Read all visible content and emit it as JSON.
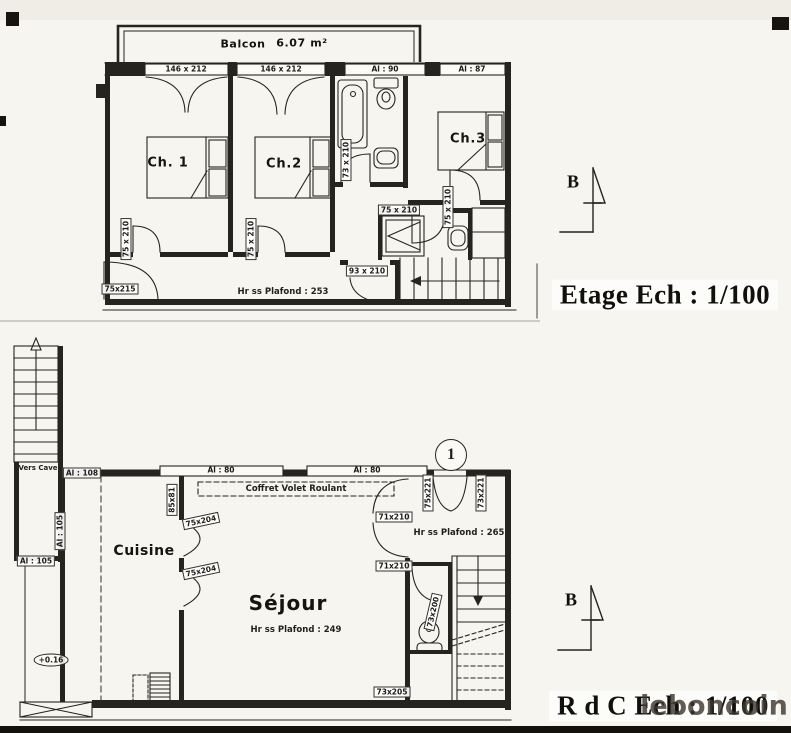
{
  "meta": {
    "watermark": "leboncoin"
  },
  "etage": {
    "title": "Etage Ech : 1/100",
    "section_marker": "B",
    "balcony": {
      "label": "Balcon",
      "area": "6.07 m²"
    },
    "windows": {
      "w1": "146 x 212",
      "w2": "146 x 212",
      "w3": "Al : 90",
      "w4": "Al : 87"
    },
    "rooms": {
      "ch1": "Ch. 1",
      "ch2": "Ch.2",
      "ch3": "Ch.3"
    },
    "ceiling_note": "Hr ss Plafond : 253",
    "doors": {
      "ch1": "75 x 210",
      "ch2": "75 x 210",
      "bath": "73 x 210",
      "shower": "75 x 210",
      "ch3": "75 x 210",
      "hall": "93 x 210",
      "entry": "75x215"
    }
  },
  "rdc": {
    "title": "R d C Ech : 1/100",
    "section_marker": "B",
    "stair_note": "Vers Cave",
    "marker_1": "1",
    "level_marker": "+0.16",
    "coffret_note": "Coffret Volet Roulant",
    "windows": {
      "al108": "Al : 108",
      "al105_side": "Al : 105",
      "al105_low": "Al : 105",
      "al80_a": "Al : 80",
      "al80_b": "Al : 80",
      "kitchen": "85x81"
    },
    "rooms": {
      "cuisine": "Cuisine",
      "sejour": "Séjour"
    },
    "ceiling_notes": {
      "entry": "Hr ss Plafond : 265",
      "sejour": "Hr ss Plafond : 249"
    },
    "doors": {
      "kitchen_a": "75x204",
      "kitchen_b": "75x204",
      "french_left": "75x221",
      "french_right": "73x221",
      "sejour_a": "71x210",
      "sejour_b": "71x210",
      "wc": "73x200",
      "rear": "73x205"
    }
  }
}
